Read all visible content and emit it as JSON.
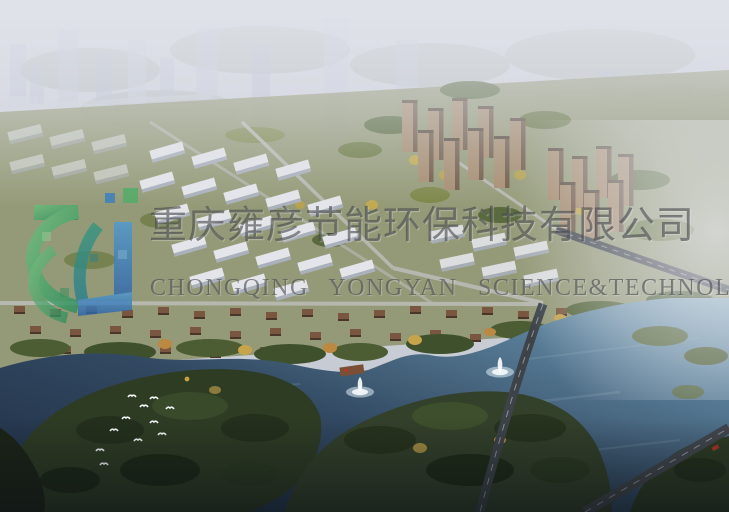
{
  "image": {
    "type": "aerial-architectural-rendering",
    "description": "Bird's-eye master-plan rendering of a lakeside residential development: hazy high-rise skyline at top, mid-rise apartment rows and brown tower clusters in midground, villa band along a dark lake with fountains, a wooded island with white birds, and a road bridge crossing the water",
    "width_px": 729,
    "height_px": 512
  },
  "watermark": {
    "company_name_cn": "重庆雍彦节能环保科技有限公司",
    "company_name_en": "CHONGQING YONGYAN SCIENCE&TECHNOLOGY",
    "text_color": "#3c3e42",
    "logo": {
      "name": "yongyan-logo",
      "style": "mosaic swoosh arcs with vertical bar",
      "colors": {
        "green": "#3fa25e",
        "teal": "#2f8b82",
        "blue": "#3472b4"
      }
    }
  },
  "scene": {
    "sky_haze_color": "#cdd0da",
    "distant_tower_color": "#b7bdd2",
    "lake_color_dark": "#22304a",
    "lake_color_light": "#7fa3b8",
    "vegetation_color": "#4c5c33",
    "autumn_tree_colors": [
      "#b6a14d",
      "#bd8840"
    ],
    "apartment_slab_color": "#e3e5ea",
    "tower_facade_color": "#9b8268",
    "villa_roof_color": "#7a5640",
    "road_color": "#3f444b",
    "features": {
      "fountains_visible": 2,
      "bird_flock": "white birds over wooded island",
      "bridge_road": "main road crossing the lake toward bottom center",
      "dock": "small brown pier on north shore"
    }
  }
}
